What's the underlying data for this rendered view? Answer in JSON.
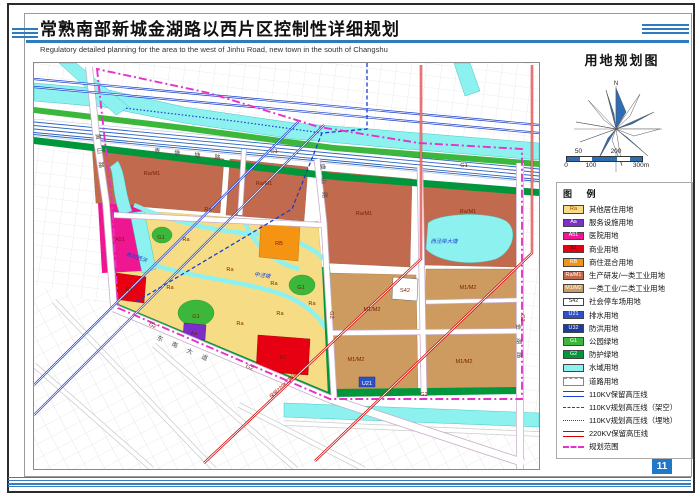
{
  "header": {
    "title": "常熟南部新城金湖路以西片区控制性详细规划",
    "subtitle": "Regulatory detailed planning for the area to the west of Jinhu Road, new town in the south of Changshu"
  },
  "panel": {
    "map_title": "用地规划图",
    "compass_north": "N",
    "scale": {
      "top_labels": [
        {
          "text": "50",
          "x": 12.5
        },
        {
          "text": "200",
          "x": 50
        }
      ],
      "bottom_labels": [
        {
          "text": "0",
          "x": 0
        },
        {
          "text": "100",
          "x": 25
        },
        {
          "text": "300m",
          "x": 75
        }
      ],
      "segments": [
        {
          "w": 12.5,
          "c": "#2e6db4"
        },
        {
          "w": 12.5,
          "c": "#ffffff"
        },
        {
          "w": 25,
          "c": "#2e6db4"
        },
        {
          "w": 12.5,
          "c": "#ffffff"
        },
        {
          "w": 12.5,
          "c": "#2e6db4"
        }
      ]
    },
    "legend_title": "图 例",
    "legend": [
      {
        "swatch": "fill",
        "code": "Ra",
        "color": "#F6DD85",
        "codeColor": "#a33b00",
        "label": "其他居住用地"
      },
      {
        "swatch": "fill",
        "code": "Aa",
        "color": "#7B2EC8",
        "codeColor": "#ffffff",
        "label": "服务设施用地"
      },
      {
        "swatch": "fill",
        "code": "A51",
        "color": "#EE1691",
        "codeColor": "#ffffff",
        "label": "医院用地"
      },
      {
        "swatch": "fill",
        "code": "B1",
        "color": "#E60012",
        "codeColor": "#5a0000",
        "label": "商业用地"
      },
      {
        "swatch": "fill",
        "code": "RB",
        "color": "#F59413",
        "codeColor": "#ffffff",
        "label": "商住混合用地"
      },
      {
        "swatch": "fill",
        "code": "Ra/M1",
        "color": "#C16A4E",
        "codeColor": "#ffffff",
        "label": "生产研发/一类工业用地"
      },
      {
        "swatch": "fill",
        "code": "M1/M2",
        "color": "#CD9A5F",
        "codeColor": "#ffffff",
        "label": "一类工业/二类工业用地"
      },
      {
        "swatch": "fill",
        "code": "S42",
        "color": "#FFFFFF",
        "codeColor": "#222222",
        "label": "社会停车场用地"
      },
      {
        "swatch": "fill",
        "code": "U21",
        "color": "#2B52C8",
        "codeColor": "#ffffff",
        "label": "排水用地"
      },
      {
        "swatch": "fill",
        "code": "U32",
        "color": "#1C3CA0",
        "codeColor": "#ffffff",
        "label": "防洪用地"
      },
      {
        "swatch": "fill",
        "code": "G1",
        "color": "#3BB83B",
        "codeColor": "#ffffff",
        "label": "公园绿地"
      },
      {
        "swatch": "fill",
        "code": "G2",
        "color": "#00963B",
        "codeColor": "#ffffff",
        "label": "防护绿地"
      },
      {
        "swatch": "fill",
        "code": "",
        "color": "#8DF1EF",
        "codeColor": "#222",
        "label": "水域用地"
      },
      {
        "swatch": "road",
        "label": "道路用地"
      },
      {
        "swatch": "line2-blue",
        "label": "110KV保留高压线"
      },
      {
        "swatch": "dashdot-blue",
        "label": "110KV规划高压线（架空）"
      },
      {
        "swatch": "dash-blue",
        "label": "110KV规划高压线（埋地）"
      },
      {
        "swatch": "line2-red",
        "label": "220KV保留高压线"
      },
      {
        "swatch": "dash-magenta",
        "label": "规划范围"
      }
    ]
  },
  "page_number": "11",
  "map": {
    "zone_labels": [
      {
        "text": "Ra/M1",
        "x": 118,
        "y": 112
      },
      {
        "text": "Ra/M1",
        "x": 230,
        "y": 122
      },
      {
        "text": "Ra/M1",
        "x": 330,
        "y": 152
      },
      {
        "text": "Ra/M1",
        "x": 434,
        "y": 150
      },
      {
        "text": "M1/M2",
        "x": 338,
        "y": 248
      },
      {
        "text": "M1/M2",
        "x": 434,
        "y": 226
      },
      {
        "text": "M1/M2",
        "x": 322,
        "y": 298
      },
      {
        "text": "M1/M2",
        "x": 430,
        "y": 300
      },
      {
        "text": "Ra",
        "x": 152,
        "y": 178
      },
      {
        "text": "Ra",
        "x": 136,
        "y": 226
      },
      {
        "text": "Ra",
        "x": 196,
        "y": 208
      },
      {
        "text": "Ra",
        "x": 240,
        "y": 222
      },
      {
        "text": "Ra",
        "x": 206,
        "y": 262
      },
      {
        "text": "Ra",
        "x": 246,
        "y": 252
      },
      {
        "text": "Ra",
        "x": 278,
        "y": 242
      },
      {
        "text": "Ra",
        "x": 174,
        "y": 148
      },
      {
        "text": "A51",
        "x": 86,
        "y": 178
      },
      {
        "text": "B1",
        "x": 95,
        "y": 228
      },
      {
        "text": "B1",
        "x": 249,
        "y": 296
      },
      {
        "text": "RB",
        "x": 245,
        "y": 182
      },
      {
        "text": "Aa",
        "x": 160,
        "y": 272
      },
      {
        "text": "S42",
        "x": 371,
        "y": 229
      },
      {
        "text": "U21",
        "x": 333,
        "y": 322,
        "c": "wh"
      },
      {
        "text": "G1",
        "x": 162,
        "y": 255
      },
      {
        "text": "G1",
        "x": 267,
        "y": 226
      },
      {
        "text": "G1",
        "x": 127,
        "y": 176
      },
      {
        "text": "G1",
        "x": 240,
        "y": 90
      },
      {
        "text": "G1",
        "x": 430,
        "y": 104
      },
      {
        "text": "G2",
        "x": 118,
        "y": 264,
        "r": 23
      },
      {
        "text": "G2",
        "x": 215,
        "y": 306,
        "r": 23
      },
      {
        "text": "G2",
        "x": 296,
        "y": 252,
        "r": 88
      },
      {
        "text": "G2",
        "x": 390,
        "y": 333
      },
      {
        "text": "G2",
        "x": 487,
        "y": 255,
        "r": 88
      }
    ],
    "road_labels": [
      {
        "text": "青墩塘路",
        "x": 160,
        "y": 94,
        "r": 6,
        "ls": 14
      },
      {
        "text": "黄山路",
        "x": 64,
        "y": 92,
        "r": 84,
        "ls": 8
      },
      {
        "text": "虞山路",
        "x": 288,
        "y": 122,
        "r": 86,
        "ls": 8
      },
      {
        "text": "东南大道",
        "x": 152,
        "y": 289,
        "r": 23,
        "ls": 10
      },
      {
        "text": "金湖路",
        "x": 483,
        "y": 282,
        "r": 88,
        "ls": 8
      }
    ],
    "water_labels": [
      {
        "text": "新村西浜",
        "x": 102,
        "y": 196,
        "r": 18
      },
      {
        "text": "中泾塘",
        "x": 228,
        "y": 214,
        "r": 8
      },
      {
        "text": "西泾岸大塘",
        "x": 410,
        "y": 180
      }
    ],
    "hv_labels": [
      {
        "text": "保留220KV高压线",
        "x": 252,
        "y": 322,
        "r": -43
      }
    ]
  },
  "colors": {
    "header_blue": "#2f7bbf",
    "water": "#8DF1EF",
    "boundary_magenta": "#e632c8",
    "hv_red": "#d40000",
    "hv_blue": "#1b3fd0",
    "page_number_bg": "#1f78c8"
  }
}
